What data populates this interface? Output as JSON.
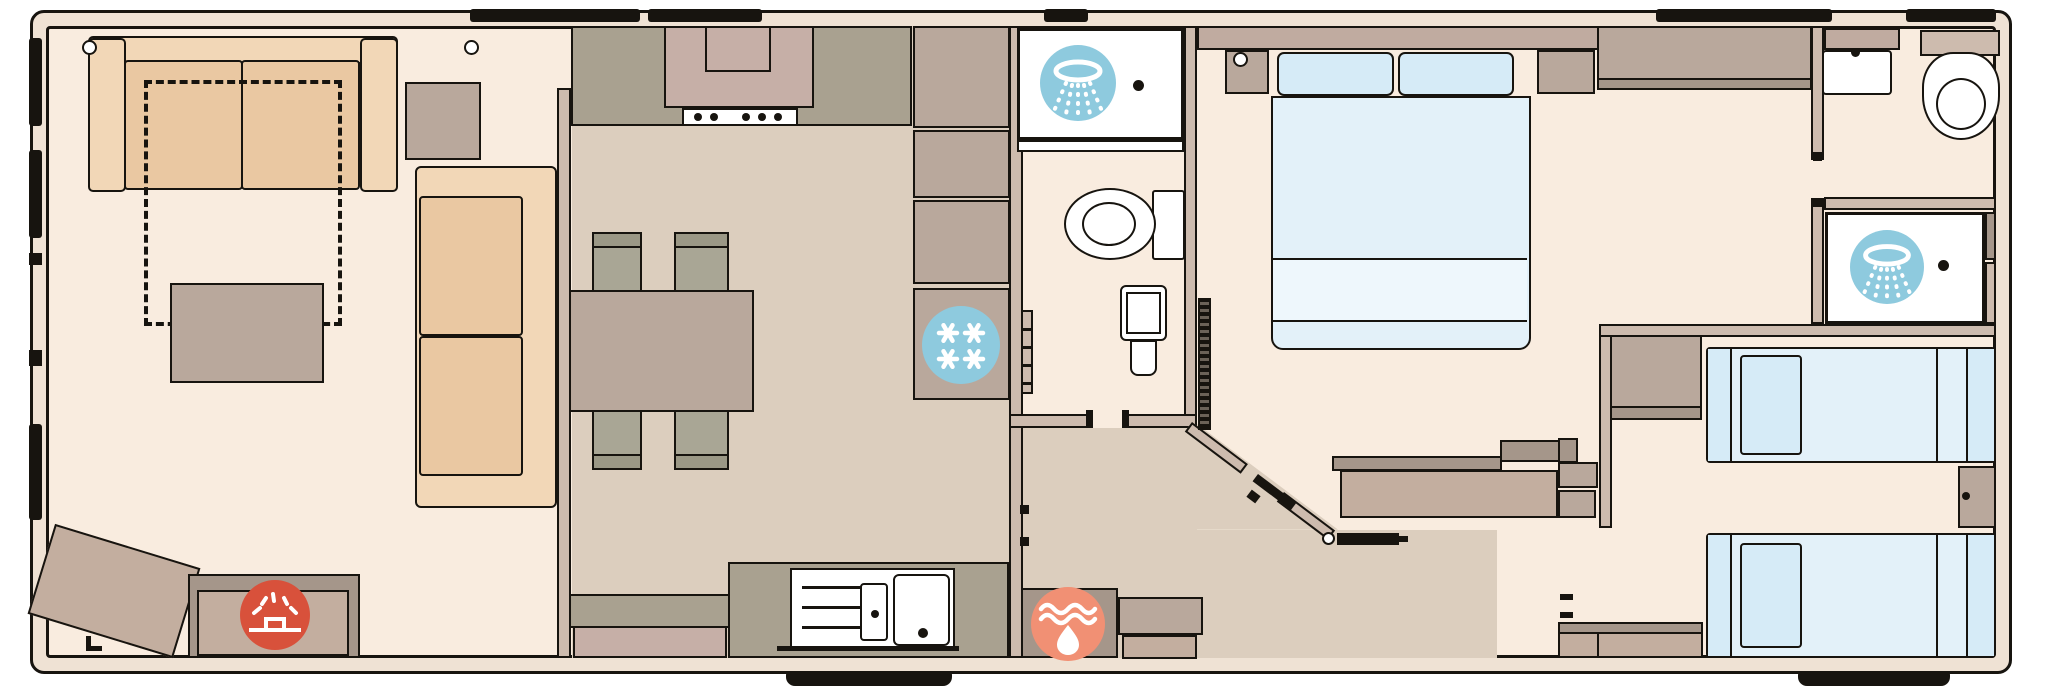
{
  "title": "static caravan holiday home floorplan (no visible text in image)",
  "colors": {
    "background": "#ffffff",
    "outline": "#17140f",
    "wall-exterior-fill": "#efe2d4",
    "wall-interior-fill": "#cdbbae",
    "floor-light": "#f9ecdf",
    "floor-dark": "#dccebe",
    "sofa-beige": "#eac8a2",
    "sofa-beige-light": "#f2d7b7",
    "unit-taupe": "#b9a89c",
    "unit-taupe-dark": "#a5968a",
    "unit-mauve": "#c3ae9f",
    "worktop-olive": "#a9a190",
    "cooker-mauve": "#c6afa7",
    "chair-grey": "#a9a695",
    "chair-grey-dark": "#9b9886",
    "overhead-taupe": "#c0aba0",
    "bed-blue": "#e3f1f9",
    "bed-blue-panel": "#d6ebf7",
    "bed-blue-fold": "#eef7fc",
    "icon-blue": "#8ecade",
    "icon-red": "#d8513b",
    "icon-orange": "#f19074",
    "white": "#ffffff"
  },
  "icons": [
    {
      "name": "shower-icon",
      "glyph": "shower-spray-circle",
      "color": "#8ecade",
      "count": 2
    },
    {
      "name": "freezer-icon",
      "glyph": "four-snowflakes-circle",
      "color": "#8ecade",
      "count": 1
    },
    {
      "name": "electric-fire-icon",
      "glyph": "radiant-fire-circle",
      "color": "#d8513b",
      "count": 1
    },
    {
      "name": "boiler-icon",
      "glyph": "flame-waves-circle",
      "color": "#f19074",
      "count": 1
    }
  ],
  "rooms": [
    {
      "name": "lounge"
    },
    {
      "name": "dining-kitchen"
    },
    {
      "name": "shower-room"
    },
    {
      "name": "master-bedroom"
    },
    {
      "name": "ensuite-wc"
    },
    {
      "name": "ensuite-shower"
    },
    {
      "name": "twin-bedroom"
    }
  ]
}
